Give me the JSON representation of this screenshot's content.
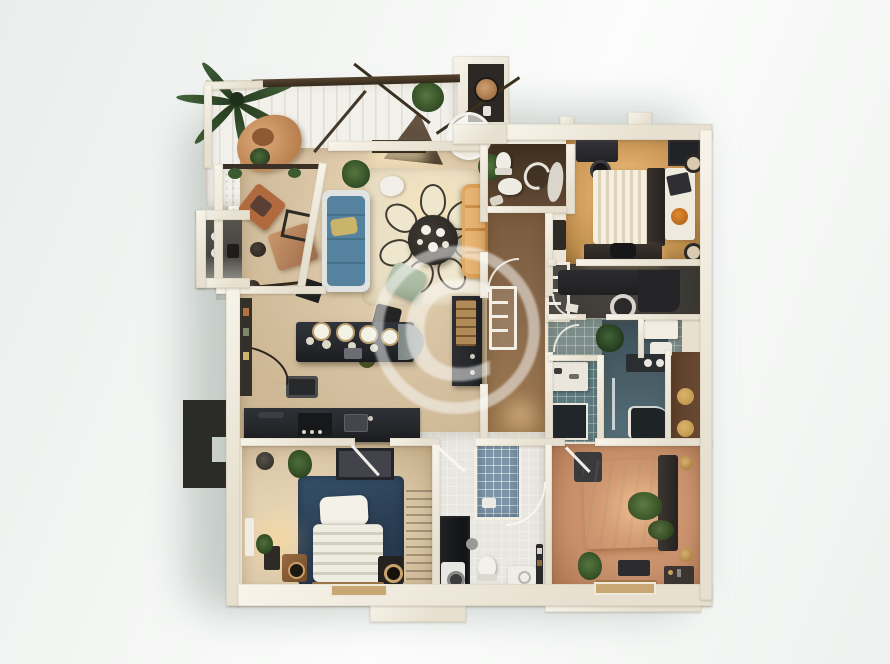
{
  "watermark": {
    "symbol": "©"
  },
  "palette": {
    "wall": "#e7e0d0",
    "wood_light": "#d7c3a3",
    "wood_kitchen": "#cdb794",
    "wood_corridor": "#8a6a4c",
    "wood_entry": "#53402e",
    "wood_warm": "#c0904f",
    "wood_warm_glow": "#f3cd8f",
    "floor_office": "#47443f",
    "floor_vestibule": "#7d8d89",
    "teal_bath": "#5e7b7e",
    "teal_bath_dark": "#4b6069",
    "tile_white": "#e8e6e0",
    "shower_blue": "#7c94a6",
    "terracotta": "#c78f6a",
    "wood_bed2": "#dcc9a9",
    "rug_navy": "#2b3f54",
    "rug_cream": "#e8dcc2",
    "rug_white": "#edebe3",
    "terrace_plank": "#f1f0ea",
    "counter_dark": "#26282c",
    "sofa_blue": "#55839f",
    "sofa_orange": "#d7994f",
    "chair_sage": "#a9b9a2",
    "chair_terracotta": "#b06a3d",
    "wardrobe_brown": "#5a4030",
    "closet_brown": "#6e4c34",
    "plant_green": "#3e5c35",
    "accent_gold": "#c19a52",
    "dark_shape": "#2b2b28",
    "bed_white": "#f2efe4"
  },
  "rooms": [
    {
      "id": "terrace",
      "label": "terrace"
    },
    {
      "id": "lounge",
      "label": "outdoor-lounge"
    },
    {
      "id": "utility-module",
      "label": "utility-module"
    },
    {
      "id": "living-room",
      "label": "living-room"
    },
    {
      "id": "dining-area",
      "label": "dining-area"
    },
    {
      "id": "kitchen",
      "label": "kitchen"
    },
    {
      "id": "entry-wc",
      "label": "entry-wc"
    },
    {
      "id": "corridor",
      "label": "corridor"
    },
    {
      "id": "top-closet",
      "label": "storage-closet"
    },
    {
      "id": "bedroom-1",
      "label": "bedroom-top-right"
    },
    {
      "id": "office",
      "label": "office"
    },
    {
      "id": "bathroom-teal-left",
      "label": "bathroom-teal-left"
    },
    {
      "id": "bathroom-teal-right",
      "label": "bathroom-teal-right"
    },
    {
      "id": "linen-closet",
      "label": "linen-closet"
    },
    {
      "id": "master-bedroom",
      "label": "master-bedroom"
    },
    {
      "id": "bathroom-main",
      "label": "main-bathroom"
    },
    {
      "id": "bedroom-2",
      "label": "bedroom-bottom-left"
    }
  ]
}
